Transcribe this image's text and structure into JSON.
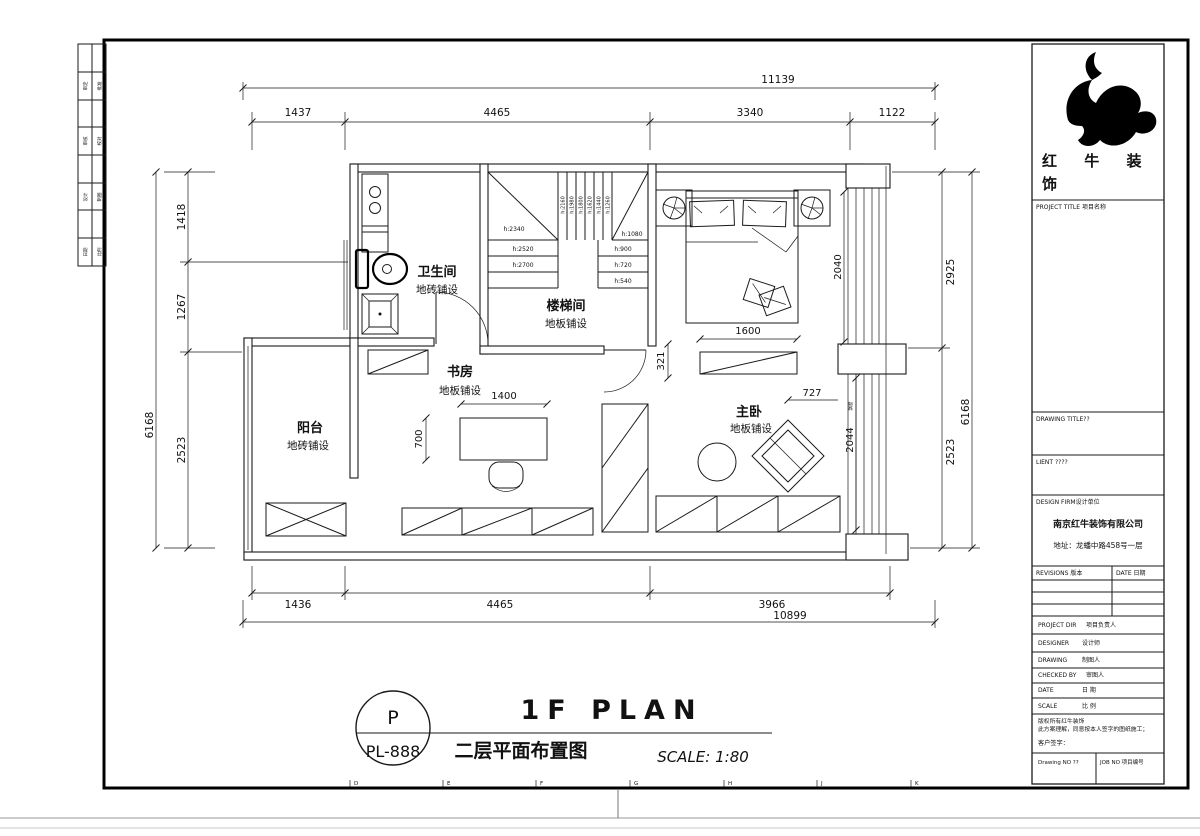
{
  "dims": {
    "top_total": "11139",
    "top_segs": [
      "1437",
      "4465",
      "3340",
      "1122"
    ],
    "bottom_segs": [
      "1436",
      "4465",
      "3966"
    ],
    "bottom_total": "10899",
    "left_total": "6168",
    "left_segs": [
      "1418",
      "1267",
      "2523"
    ],
    "right_segs": [
      "2925",
      "2523"
    ],
    "right_total": "6168",
    "d1400": "1400",
    "d700": "700",
    "d1600": "1600",
    "d727": "727",
    "d321": "321",
    "d2040": "2040",
    "d2044": "2044",
    "bay_tag": "飘窗"
  },
  "stairs": {
    "left": [
      "h:2340",
      "h:2520",
      "h:2700"
    ],
    "mid": [
      "h:2160",
      "h:1980",
      "h:1800",
      "h:1620",
      "h:1440",
      "h:1260"
    ],
    "right": [
      "h:1080",
      "h:900",
      "h:720",
      "h:540"
    ]
  },
  "rooms": {
    "bathroom": {
      "name": "卫生间",
      "finish": "地砖铺设"
    },
    "stairwell": {
      "name": "楼梯间",
      "finish": "地板铺设"
    },
    "study": {
      "name": "书房",
      "finish": "地板铺设"
    },
    "balcony": {
      "name": "阳台",
      "finish": "地砖铺设"
    },
    "master": {
      "name": "主卧",
      "finish": "地板铺设"
    }
  },
  "footer": {
    "stamp_top": "P",
    "stamp_bottom": "PL-888",
    "title_en": "1F PLAN",
    "title_cn": "二层平面布置图",
    "scale": "SCALE: 1:80"
  },
  "title_block": {
    "logo_line1": "红 牛 装",
    "logo_line2": "饰",
    "project_title": "PROJECT TITLE 项目名称",
    "drawing_title": "DRAWING TITLE??",
    "client": "LIENT ????",
    "design_firm": "DESIGN FIRM设计单位",
    "firm_name": "南京红牛装饰有限公司",
    "firm_address": "地址：龙蟠中路458号一层",
    "revisions": "REVISIONS 版本",
    "date_col": "DATE 日期",
    "rows": [
      {
        "label": "PROJECT DIR",
        "value": "项目负责人"
      },
      {
        "label": "DESIGNER",
        "value": "设计师"
      },
      {
        "label": "DRAWING",
        "value": "制图人"
      },
      {
        "label": "CHECKED BY",
        "value": "审图人"
      },
      {
        "label": "DATE",
        "value": "日 期"
      },
      {
        "label": "SCALE",
        "value": "比 例"
      }
    ],
    "note1": "版权所有红牛装饰",
    "note2": "此方案理解，同意按本人签字的图纸施工；",
    "note3": "客户签字：",
    "drawing_no": "Drawing NO ??",
    "job_no": "JOB NO 项目编号"
  },
  "frame": {
    "letters": [
      "D",
      "E",
      "F",
      "G",
      "H",
      "J",
      "K"
    ],
    "strip": [
      [
        "审定",
        "批准"
      ],
      [
        "审核",
        "校对"
      ],
      [
        "设计",
        "制图"
      ],
      [
        "日期",
        "比例"
      ]
    ]
  }
}
